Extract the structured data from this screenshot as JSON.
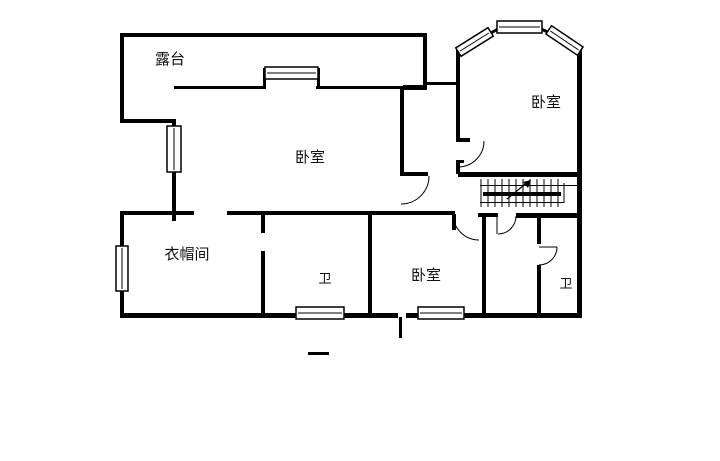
{
  "page": {
    "background_color": "#ffffff",
    "line_color": "#000000",
    "text_color": "#111111"
  },
  "floor_plan": {
    "rooms": [
      {
        "id": "terrace",
        "label": "露台"
      },
      {
        "id": "bedroom-center",
        "label": "卧室"
      },
      {
        "id": "bedroom-top-right",
        "label": "卧室"
      },
      {
        "id": "cloakroom",
        "label": "衣帽间"
      },
      {
        "id": "bathroom-center",
        "label": "卫"
      },
      {
        "id": "bedroom-bottom",
        "label": "卧室"
      },
      {
        "id": "bathroom-right",
        "label": "卫"
      }
    ],
    "symbols": {
      "staircase": "staircase-with-up-arrow",
      "window": "double-line-window",
      "door": "quarter-arc-door-swing",
      "scale_mark": "short-dash"
    }
  }
}
